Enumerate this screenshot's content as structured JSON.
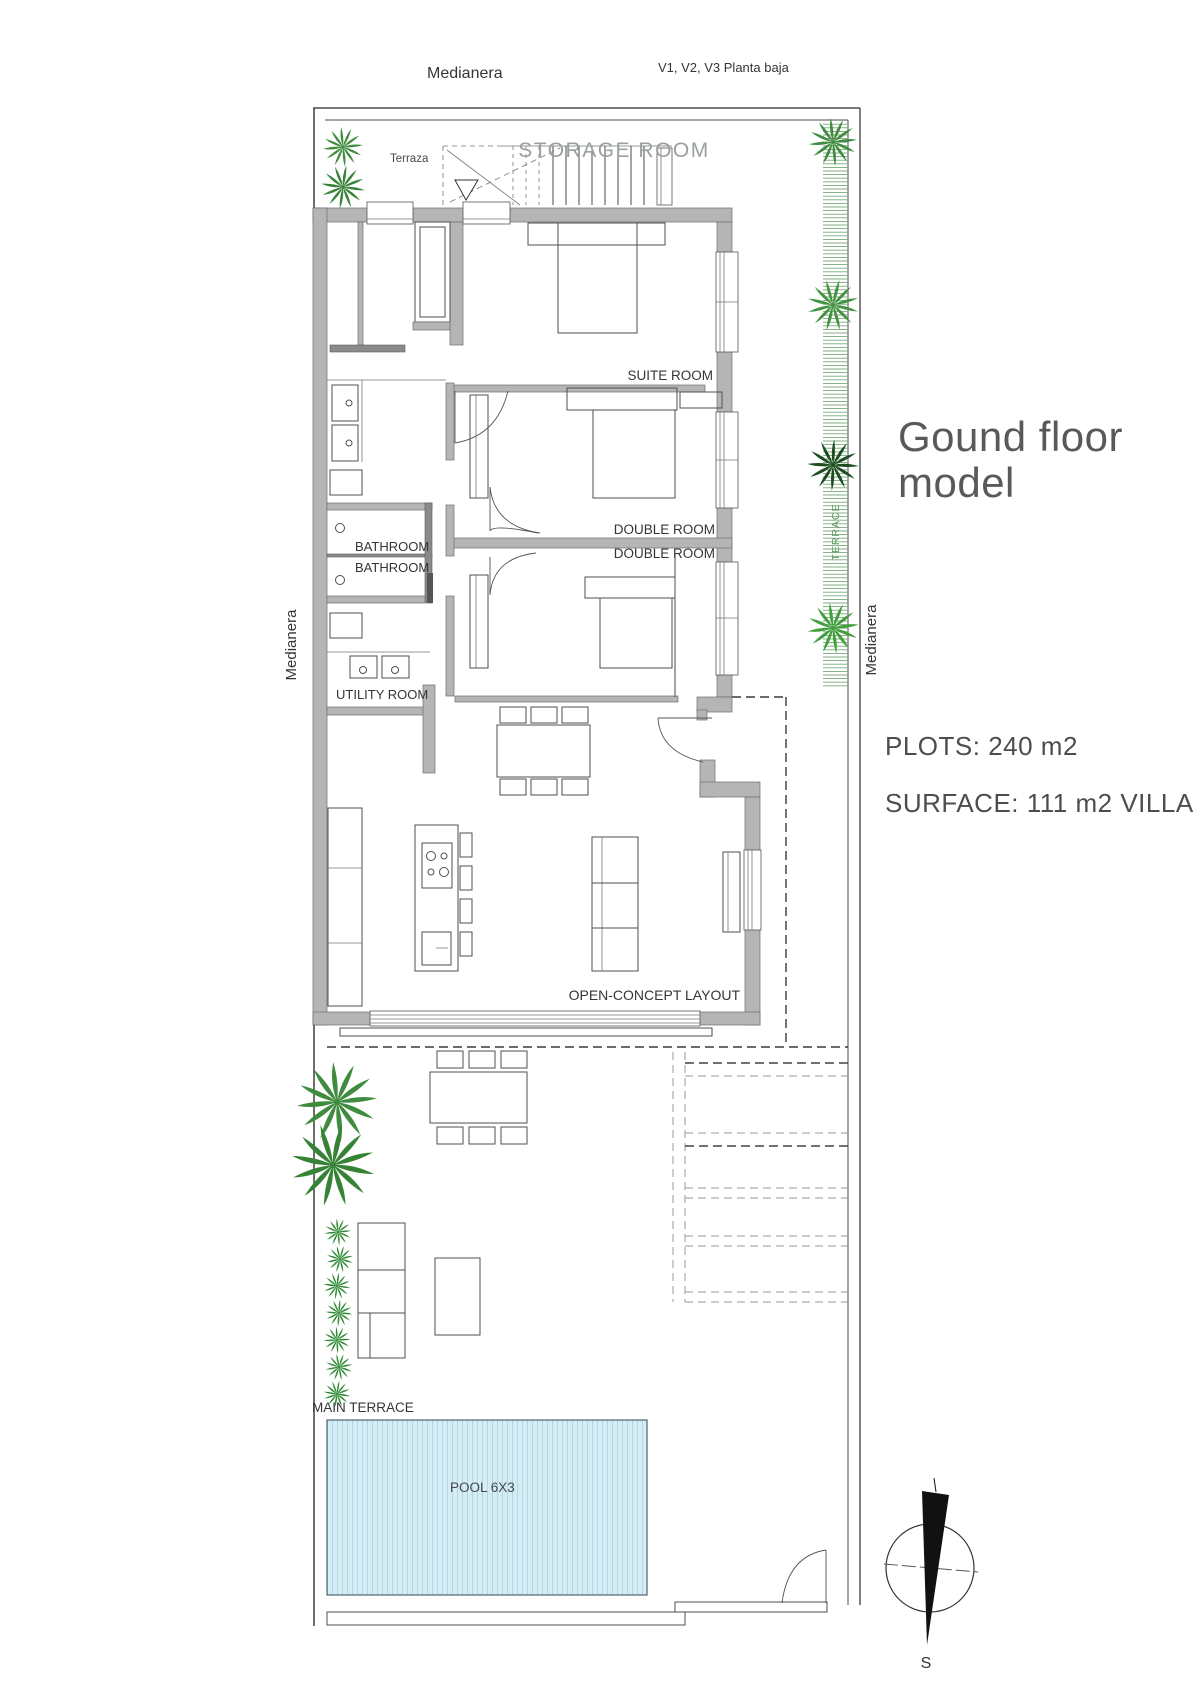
{
  "header": {
    "medianera_top": "Medianera",
    "plan_ref": "V1, V2, V3 Planta baja"
  },
  "side_labels": {
    "medianera_left": "Medianera",
    "medianera_right": "Medianera",
    "terrace_vertical": "TERRACE",
    "terraza": "Terraza"
  },
  "rooms": {
    "storage": "STORAGE ROOM",
    "suite": "SUITE ROOM",
    "double1": "DOUBLE ROOM",
    "double2": "DOUBLE ROOM",
    "bathroom1": "BATHROOM",
    "bathroom2": "BATHROOM",
    "utility": "UTILITY ROOM",
    "open_concept": "OPEN-CONCEPT LAYOUT",
    "main_terrace": "MAIN TERRACE",
    "pool": "POOL 6X3"
  },
  "info_panel": {
    "title_line1": "Gound floor",
    "title_line2": "model",
    "plots": "PLOTS: 240 m2",
    "surface": "SURFACE: 111 m2 VILLA"
  },
  "compass": {
    "south_label": "S"
  },
  "colors": {
    "wall": "#b5b5b5",
    "line": "#4a4a4a",
    "storage_text": "#9aa0a2",
    "title_text": "#58595b",
    "info_text": "#4c4d4f",
    "green": "#3f8c3f",
    "green_text": "#59975a",
    "pool_fill": "#d7edf5",
    "pool_stripe": "#b3d7e3",
    "pool_border": "#49656e",
    "label_text": "#353535"
  }
}
